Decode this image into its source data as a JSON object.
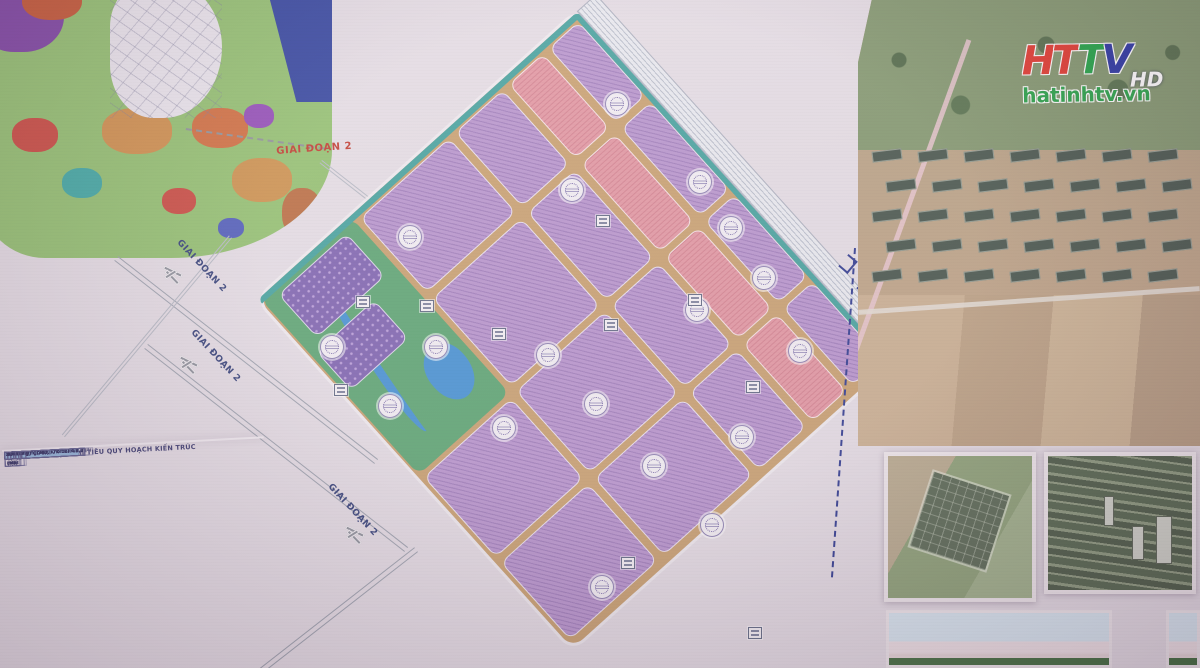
{
  "watermark": {
    "brand": "HTTV",
    "hd": "HD",
    "site": "hatinhtv.vn"
  },
  "plan": {
    "phase_labels": [
      {
        "text": "GIAI ĐOẠN 2"
      },
      {
        "text": "GIAI ĐOẠN 2"
      },
      {
        "text": "GIAI ĐOẠN 2"
      },
      {
        "text": "GIAI ĐOẠN 2"
      }
    ],
    "road_to_city_label": "ĐI TRUNG TÂM TP HÀ TĨNH"
  },
  "table": {
    "title": "BẢNG TỔNG HỢP CHỈ TIÊU QUY HOẠCH KIẾN TRÚC",
    "columns": [
      "Thành phần đất",
      "Ký hiệu",
      "Diện tích (ha)",
      "Tỷ lệ (%)",
      "Tầng cao tối đa",
      "MĐXD (%)",
      "Diện tích sàn (ha)",
      "HSSDĐ (lần)"
    ],
    "rows": [
      {
        "name": "Đất công cộng",
        "sym": "",
        "v": [
          "17.62",
          "8.76",
          "10",
          "50",
          "85.1",
          "5"
        ],
        "style": "orange"
      },
      {
        "name": "Đất công cộng A.DV 1",
        "sym": "A.DV 1",
        "v": [
          "1.02",
          "0.96",
          "10",
          "50",
          "5.1",
          "5"
        ],
        "style": ""
      },
      {
        "name": "Đất công cộng A.DV 2",
        "sym": "A.DV 2",
        "v": [
          "3.0",
          "2.09",
          "10",
          "50",
          "15.0",
          "5"
        ],
        "style": ""
      },
      {
        "name": "Đất công cộng A.DV 3",
        "sym": "A.DV 3",
        "v": [
          "0.76",
          "0.55",
          "10",
          "50",
          "3.8",
          "5"
        ],
        "style": ""
      },
      {
        "name": "Đất công cộng A.DV 4",
        "sym": "A.DV 4",
        "v": [
          "2.87",
          "1.71",
          "10",
          "60",
          "14.35",
          "5"
        ],
        "style": ""
      },
      {
        "name": "Đất công cộng A.DV 5",
        "sym": "A.DV 5",
        "v": [
          "2.66",
          "1.87",
          "10",
          "60",
          "13.3",
          "5"
        ],
        "style": ""
      },
      {
        "name": "Đất công cộng A.DV 6",
        "sym": "A.DV 6",
        "v": [
          "2.17",
          "1.16",
          "10",
          "60",
          "10.85",
          "5"
        ],
        "style": ""
      },
      {
        "name": "Đất công cộng A.DV 7",
        "sym": "A.DV 7",
        "v": [
          "2.76",
          "1.91",
          "10",
          "60",
          "16.7",
          "5"
        ],
        "style": ""
      },
      {
        "name": "",
        "sym": "",
        "v": [
          "128.89",
          "67.21",
          "8",
          "70",
          "421.925",
          "2.8"
        ],
        "style": "total"
      },
      {
        "name": "Đất công nghiệp, kho bãi",
        "sym": "",
        "v": [
          "",
          "",
          "",
          "",
          "",
          ""
        ],
        "style": "blue"
      },
      {
        "name": "Đất công nghiệp, kho bãi A.1",
        "sym": "A.1",
        "v": [
          "11.75",
          "6.19",
          "7",
          "70",
          "41.055",
          "3.5"
        ],
        "style": ""
      },
      {
        "name": "Đất công nghiệp, kho bãi A.1.1",
        "sym": "A.1.1",
        "v": [
          "2.97",
          "",
          "7",
          "70",
          "20.79",
          "3.5"
        ],
        "style": ""
      },
      {
        "name": "Đất công nghiệp, kho bãi A.1.2",
        "sym": "A.1.2",
        "v": [
          "2.79",
          "",
          "7",
          "70",
          "19.53",
          "3.5"
        ],
        "style": ""
      },
      {
        "name": "Đất công nghiệp, kho bãi A.2",
        "sym": "A.2",
        "v": [
          "19.27",
          "8.92",
          "7",
          "70",
          "19.11",
          "3.5"
        ],
        "style": ""
      },
      {
        "name": "Đất công nghiệp, kho bãi A.2.1",
        "sym": "A.2.1",
        "v": [
          "5.44",
          "",
          "7",
          "70",
          "19.25",
          "3.5"
        ],
        "style": ""
      },
      {
        "name": "Đất công nghiệp, kho bãi A.2.2",
        "sym": "A.2.2",
        "v": [
          "3.8",
          "",
          "7",
          "70",
          "13.965",
          "3.5"
        ],
        "style": ""
      },
      {
        "name": "Đất công nghiệp, kho bãi A.2.3",
        "sym": "A.2.3",
        "v": [
          "6.11",
          "",
          "7",
          "70",
          "21.385",
          "3.5"
        ],
        "style": ""
      },
      {
        "name": "Đất công nghiệp, kho bãi A.3",
        "sym": "A.3",
        "v": [
          "13.09",
          "7.18",
          "7",
          "70",
          "18.655",
          "3.5"
        ],
        "style": ""
      },
      {
        "name": "Đất công nghiệp, kho bãi A.3.1",
        "sym": "A.3.1",
        "v": [
          "3.35",
          "",
          "7",
          "70",
          "10.185",
          "3.5"
        ],
        "style": ""
      },
      {
        "name": "Đất công nghiệp, kho bãi A.3.2",
        "sym": "A.3.2",
        "v": [
          "2.91",
          "",
          "7",
          "70",
          "13.405",
          "3.5"
        ],
        "style": ""
      },
      {
        "name": "Đất công nghiệp, kho bãi A.3.3",
        "sym": "A.3.3",
        "v": [
          "2.83",
          "",
          "7",
          "70",
          "5.67",
          "3.5"
        ],
        "style": ""
      },
      {
        "name": "Đất công nghiệp, kho bãi A.3.3 (*)",
        "sym": "A.3.4",
        "v": [
          "1.82",
          "",
          "7",
          "70",
          "8.785",
          "3.5"
        ],
        "style": ""
      },
      {
        "name": "Đất công nghiệp, kho bãi A.4 (*)",
        "sym": "A.4",
        "v": [
          "2.76",
          "1.45",
          "7",
          "70",
          "4.185",
          "3.5"
        ],
        "style": ""
      },
      {
        "name": "Đất công nghiệp, kho bãi A.4.1",
        "sym": "A.4.1",
        "v": [
          "1.39",
          "",
          "7",
          "70",
          "7.6",
          "3.5"
        ],
        "style": ""
      },
      {
        "name": "Đất công nghiệp, kho bãi A.4.2",
        "sym": "A.4.2",
        "v": [
          "1.37",
          "",
          "7",
          "70",
          "6.9",
          "3.5"
        ],
        "style": ""
      }
    ]
  },
  "colors": {
    "plot_purple": "#b692cc",
    "plot_pink": "#e2949f",
    "plot_dark_purple": "#7a5fae",
    "road_tan": "#c79e6b",
    "park_green": "#57a36e",
    "water_blue": "#3f8fd2",
    "phase_red": "#bf3527",
    "phase_navy": "#2c3a74",
    "logo_red": "#e03024",
    "logo_green": "#16a03c",
    "logo_navy": "#1f2c9e",
    "site_green": "#1d9f3e"
  }
}
